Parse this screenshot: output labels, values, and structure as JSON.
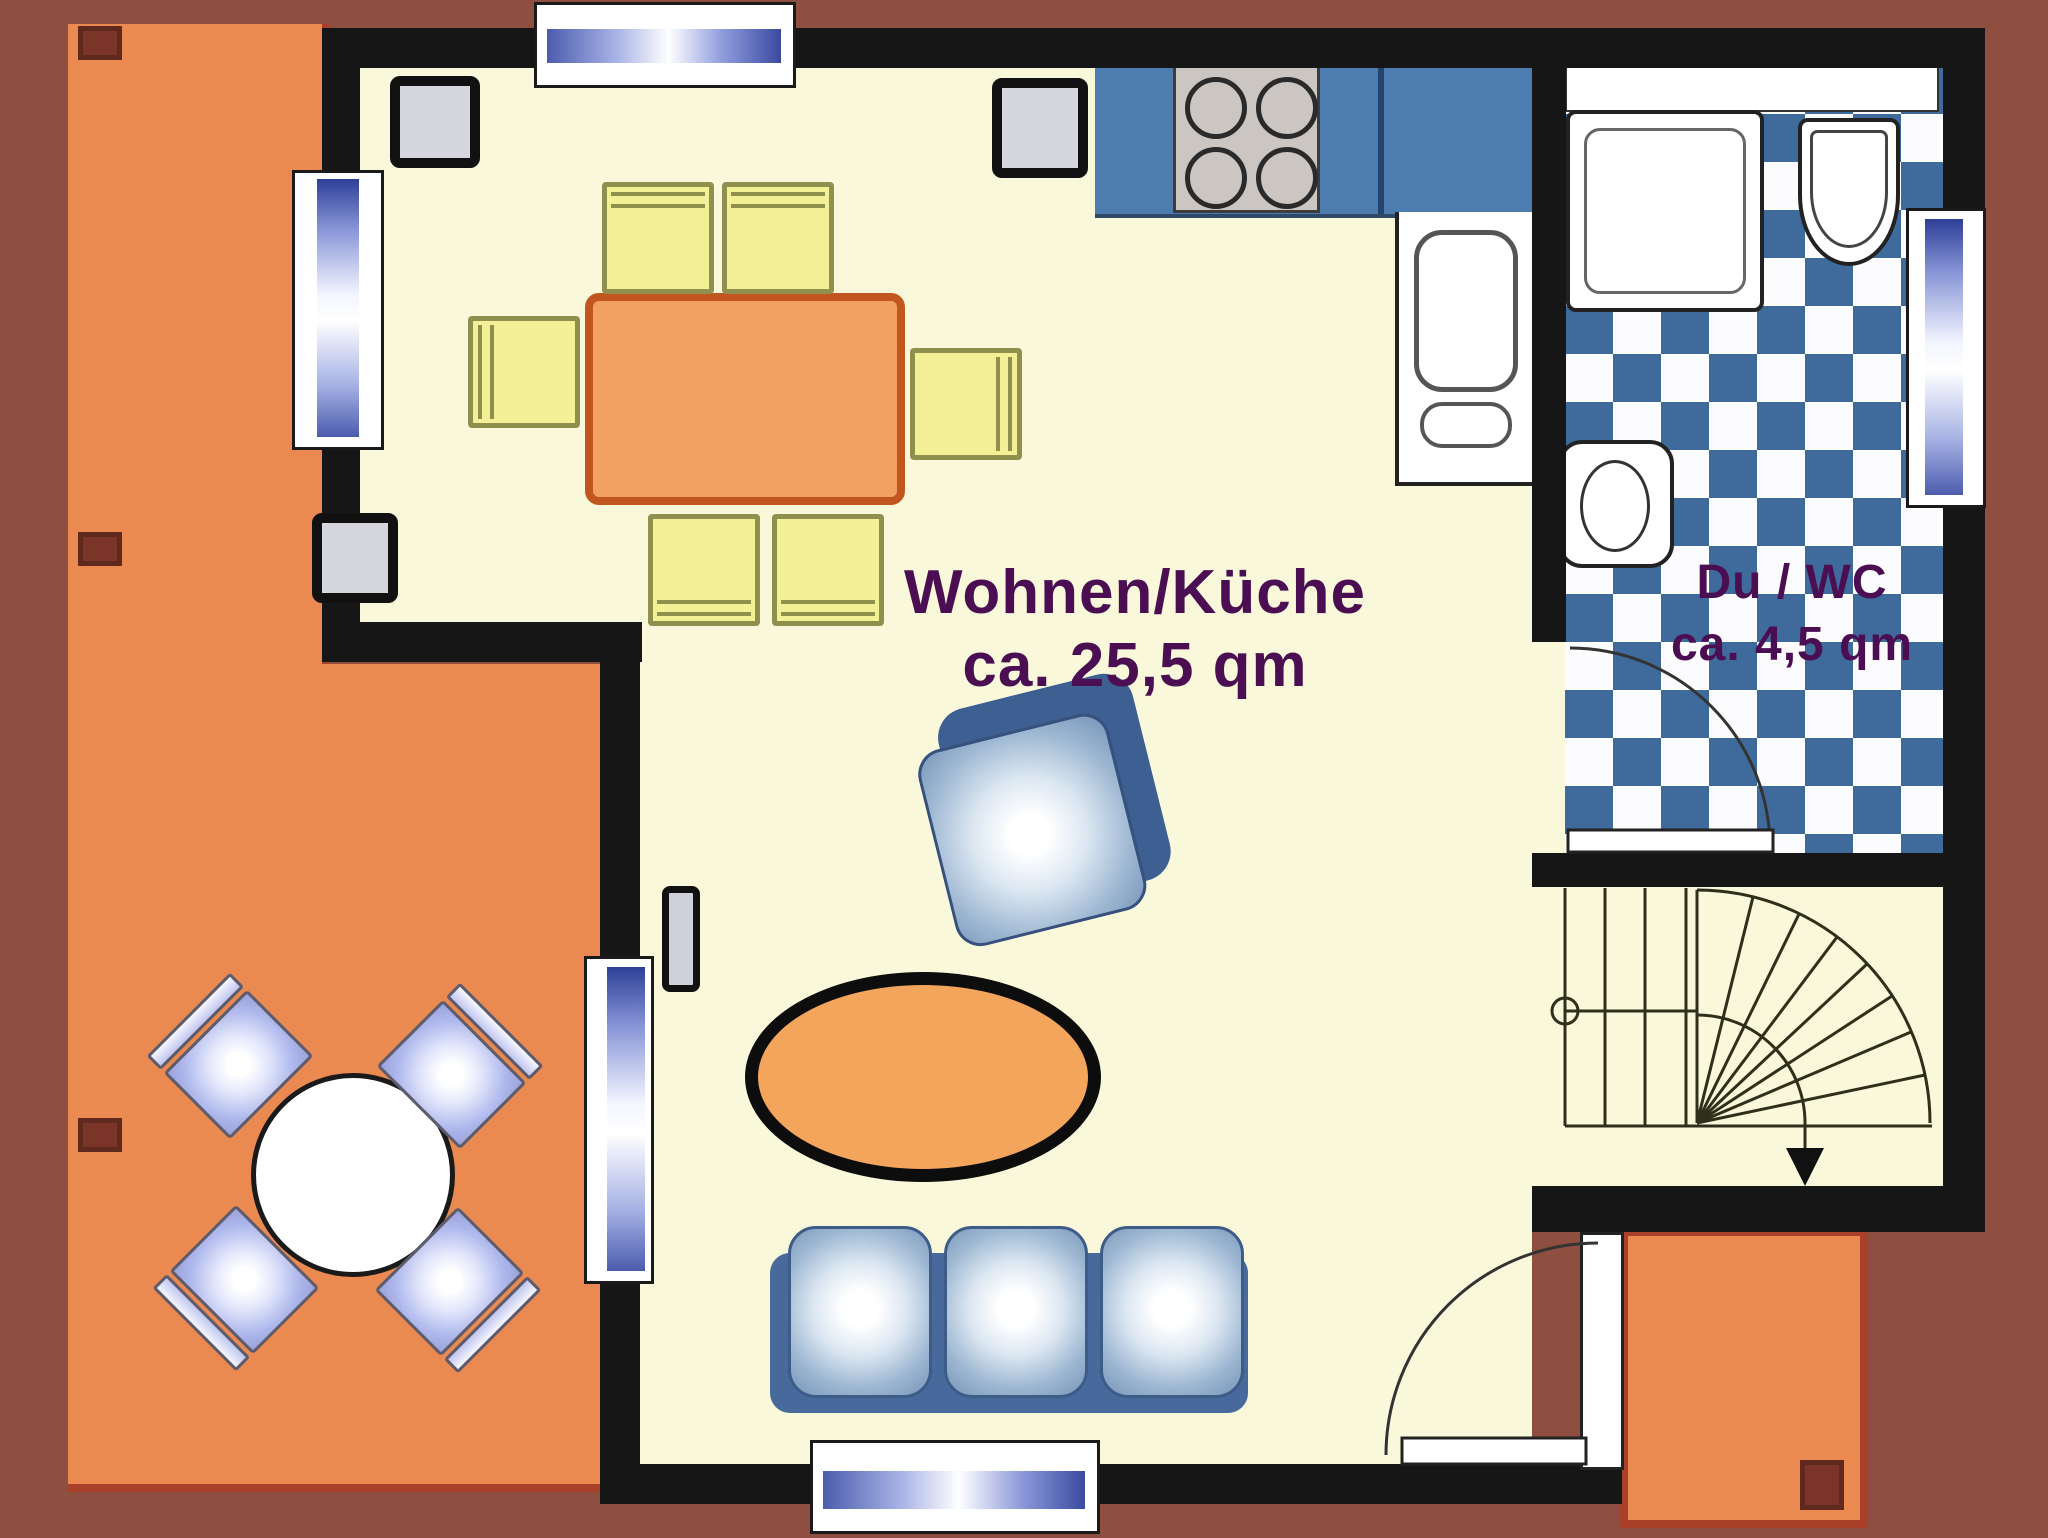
{
  "rooms": {
    "living_kitchen": {
      "name": "Wohnen/Küche",
      "area": "ca. 25,5 qm"
    },
    "shower_wc": {
      "name": "Du / WC",
      "area": "ca. 4,5 qm"
    }
  },
  "colors": {
    "background": "#8f4f40",
    "terrace": "#eb8a50",
    "wall": "#161616",
    "floor": "#f9f8da",
    "tile_blue": "#3f6b9c",
    "counter_blue": "#4c7cb0",
    "table_orange": "#f3a160",
    "chair_yellow": "#f3f095",
    "sofa_blue": "#47699c",
    "label_purple": "#4b0e52"
  },
  "fixtures": {
    "kitchen": [
      "stove-4-burners",
      "sink-counter"
    ],
    "bath": [
      "shower-tray",
      "washbasin",
      "toilet"
    ],
    "living": [
      "dining-table",
      "6-dining-chairs",
      "armchair",
      "oval-coffee-table",
      "3-seat-sofa",
      "heater"
    ],
    "terrace": [
      "round-table",
      "4-terrace-chairs"
    ],
    "circulation": [
      "winder-staircase",
      "entry-door",
      "bath-door"
    ],
    "windows": 5
  }
}
